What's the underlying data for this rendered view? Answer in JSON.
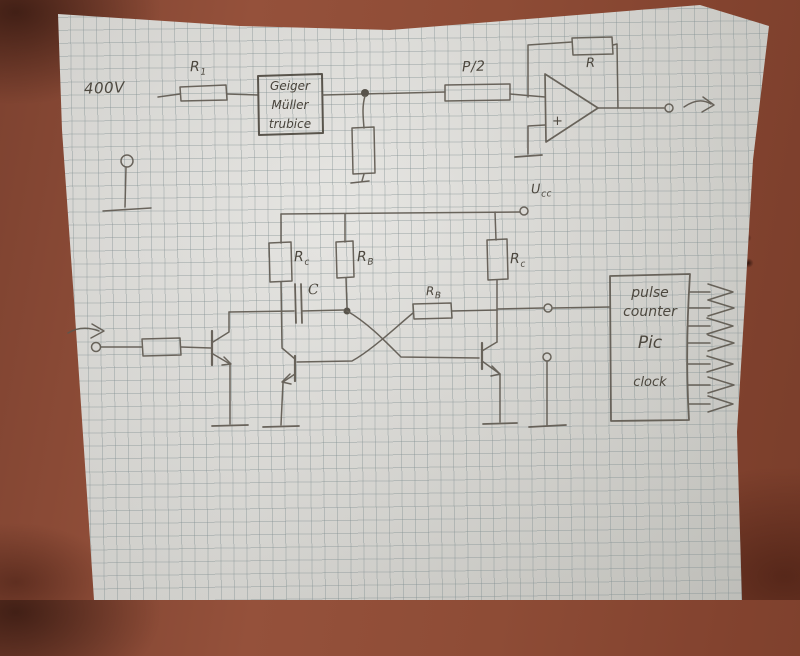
{
  "scene": {
    "surface": "reddish-brown table",
    "medium": "pencil schematic on squared graph paper",
    "colors": {
      "table": "#8e4c36",
      "paper": "#d9d8d3",
      "grid": "#8a9496",
      "pencil": "#57524a"
    }
  },
  "top": {
    "hv_label": "400V",
    "r1": {
      "main": "R",
      "sub": "1"
    },
    "geiger_lines": [
      "Geiger",
      "Müller",
      "trubice"
    ],
    "p2_label": "P/2",
    "fb_r_label": "R",
    "opamp_plus": "+"
  },
  "bottom": {
    "ucc": {
      "main": "U",
      "sub": "cc"
    },
    "rc_left": {
      "main": "R",
      "sub": "c"
    },
    "rb_left": {
      "main": "R",
      "sub": "B"
    },
    "cap_label": "C",
    "rb_mid": {
      "main": "R",
      "sub": "B"
    },
    "rc_right": {
      "main": "R",
      "sub": "c"
    },
    "counter_lines": [
      "pulse",
      "counter",
      "Pic",
      "clock"
    ]
  }
}
